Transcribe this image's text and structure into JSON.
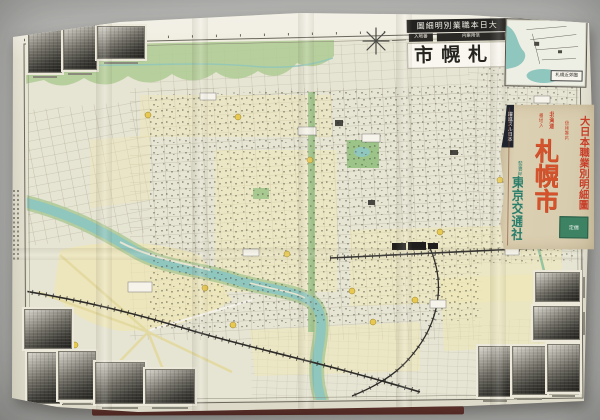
{
  "title_block": {
    "series": "大日本職業別明細圖",
    "sub_left": "番地入",
    "sub_right": "信用案内",
    "city": "札幌市"
  },
  "inset_map": {
    "label": "札幌近郊圖"
  },
  "cover": {
    "region": "北海道",
    "series_title": "大日本職業別明細圖",
    "series_sub": "信用案内",
    "edition_note": "番地入",
    "city": "札幌市",
    "badge": "躍進スル日本",
    "seller_label": "發賣所",
    "publisher": "東京交通社",
    "price_stamp": "定價"
  },
  "icons": {
    "compass": "compass-rose"
  },
  "photos": {
    "count": 12
  },
  "colors": {
    "backdrop": "#c6c6c4",
    "paper": "#e8e5d6",
    "river": "#8fc6bd",
    "park_green": "#aecb93",
    "block_yellow": "#efe7b4",
    "cover_paper": "#d9cdaf",
    "accent_red": "#c6402a",
    "city_red": "#d4532c",
    "publisher_teal": "#2c7f6c",
    "banner_black": "#232220",
    "maroon_edge": "#6e3430"
  }
}
